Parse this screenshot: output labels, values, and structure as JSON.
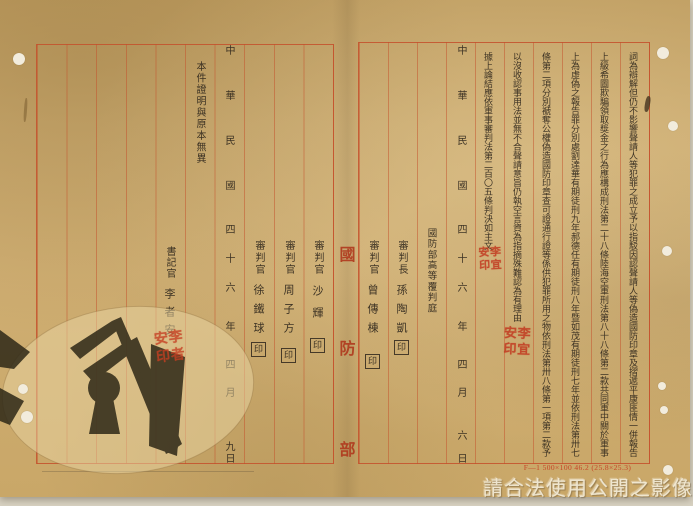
{
  "colors": {
    "paper": "#cbaa6e",
    "grid_red": "#c3502b",
    "ink": "#332c24",
    "seal_red": "#c23a20",
    "ministry_red": "#b03b1e"
  },
  "gutter": {
    "chars": [
      "國",
      "防",
      "部"
    ]
  },
  "right_page": {
    "columns": [
      "詞為辯解但仍不影響聲請人等犯罪之成立予以指駁因認聲請人等偽造國防印章及摺遞平康匪情一併報告",
      "上級希圖欺騙領取獎金之行為應構成刑法第二十八條陸海空軍刑法第八十八條第二款共同軍中關於軍事",
      "上為虛偽之報告罪分別處劉達華有期徒刑九年郝德任有期徒刑八年暨如茂有期徒刑七年並依刑法第卅七",
      "條第二項分別褫奪公權偽造國防印章查可證通行證等係供犯罪所用之物依刑法第卅八條第一項第二款予",
      "以沒收認事用法並無不合聲請意旨仍執空言資為指摘殊難認為有理由",
      "據上論結應依軍事審判法第二百〇五條判決如主文"
    ],
    "date": {
      "era": "中華民國",
      "year": "四十六",
      "year_label": "年",
      "month": "四月",
      "day": "六",
      "day_label": "日"
    },
    "court": "國防部高等覆判庭",
    "officials": [
      {
        "title": "審判長",
        "name": "孫陶凱",
        "seal_label": "印"
      },
      {
        "title": "審判官",
        "name": "曾傳棟",
        "seal_label": "印"
      }
    ],
    "seals": [
      {
        "text": "李宜安印"
      },
      {
        "text": "李宜安印"
      }
    ]
  },
  "left_page": {
    "officials": [
      {
        "title": "審判官",
        "name": "沙輝",
        "seal_label": "印"
      },
      {
        "title": "審判官",
        "name": "周子方",
        "seal_label": "印"
      },
      {
        "title": "審判官",
        "name": "徐鐵球",
        "seal_label": "印"
      }
    ],
    "date": {
      "era": "中華民國",
      "year": "四十六",
      "year_label": "年",
      "month": "四月",
      "day": "九",
      "day_label": "日"
    },
    "certification": "本件證明與原本無異",
    "clerk": {
      "title": "書記官",
      "name": "李者安"
    },
    "clerk_seal": {
      "text": "李者安印"
    }
  },
  "footer": {
    "form_code": "F—1 500×100 46.2 (25.8×25.3)",
    "watermark": "請合法使用公開之影像"
  }
}
